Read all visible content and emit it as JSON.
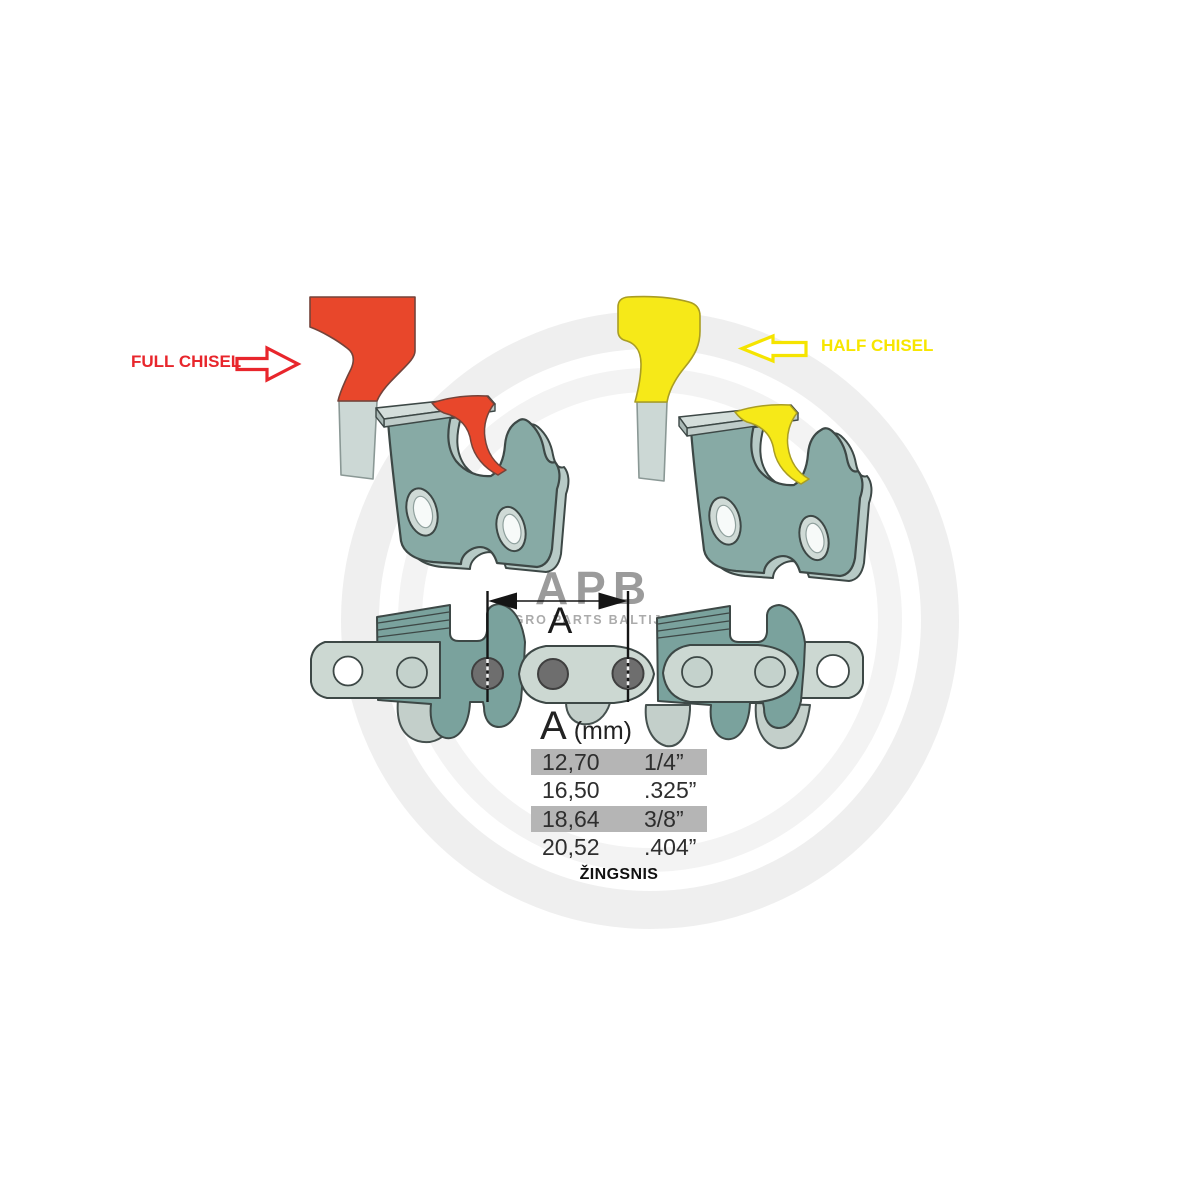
{
  "page": {
    "background": "#ffffff",
    "width": 1188,
    "height": 1188,
    "description": "Chainsaw chain cutter type and pitch diagram"
  },
  "annotations": {
    "full_chisel_label": "FULL CHISEL",
    "half_chisel_label": "HALF CHISEL",
    "dimension_label": "A",
    "pitch_caption": "ŽINGSNIS"
  },
  "watermark": {
    "logo_text": "APB",
    "logo_subtext": "AGRO PARTS BALTIJA"
  },
  "pitch_table": {
    "header_symbol": "A",
    "header_unit": "(mm)",
    "rows": [
      {
        "mm": "12,70",
        "inches": "1/4”",
        "highlighted": true
      },
      {
        "mm": "16,50",
        "inches": ".325”",
        "highlighted": false
      },
      {
        "mm": "18,64",
        "inches": "3/8”",
        "highlighted": true
      },
      {
        "mm": "20,52",
        "inches": ".404”",
        "highlighted": false
      }
    ]
  },
  "colors": {
    "full_chisel_accent": "#e8472b",
    "half_chisel_accent": "#f6e918",
    "label_red": "#e8262c",
    "label_yellow": "#f7e600",
    "chain_light": "#ccd8d2",
    "chain_dark": "#7aa29d",
    "cutter_plate": "#87aaa5",
    "rivet_gray": "#6e6e6e",
    "table_highlight": "#b5b5b5",
    "watermark_gray": "#9b9b9b"
  }
}
